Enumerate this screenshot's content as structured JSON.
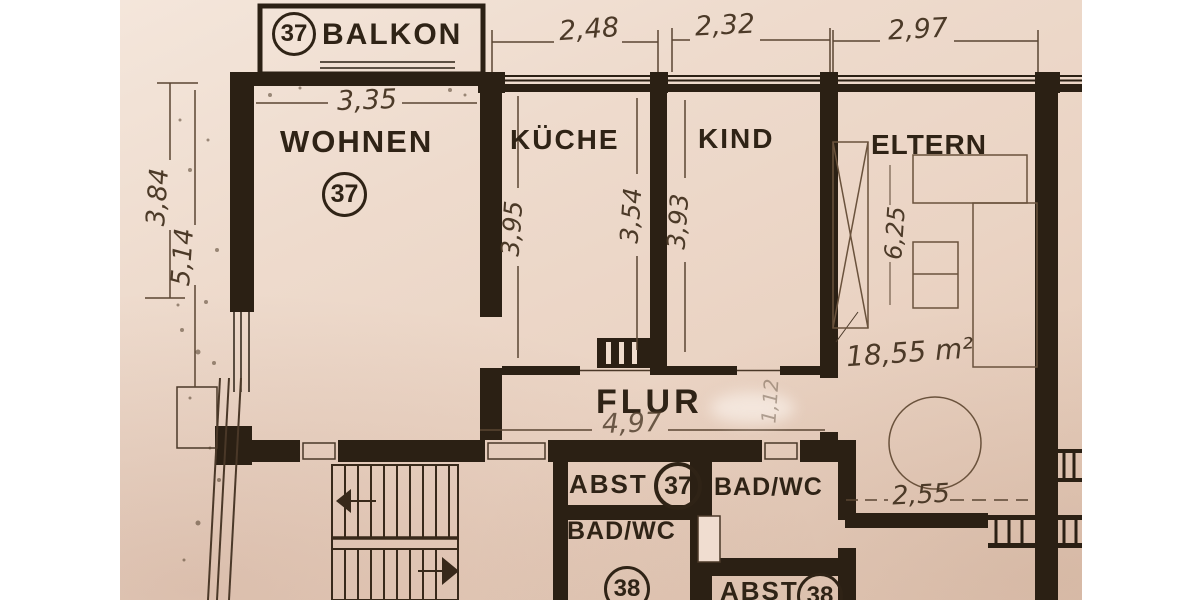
{
  "plan": {
    "balkon": {
      "unit": "37",
      "label": "BALKON"
    },
    "rooms": {
      "wohnen": {
        "label": "WOHNEN",
        "unit": "37"
      },
      "kueche": {
        "label": "KÜCHE"
      },
      "kind": {
        "label": "KIND"
      },
      "eltern": {
        "label": "ELTERN",
        "area": "18,55 m²"
      },
      "flur": {
        "label": "FLUR"
      },
      "abst37": {
        "label": "ABST",
        "unit": "37"
      },
      "badwc37": {
        "label": "BAD/WC"
      },
      "badwc38": {
        "label": "BAD/WC",
        "unit": "38"
      },
      "abst38": {
        "label": "ABST",
        "unit": "38"
      }
    },
    "dims": {
      "top_kueche": "2,48",
      "top_kind": "2,32",
      "top_eltern": "2,97",
      "wohnen_width": "3,35",
      "left_upper": "3,84",
      "left_full": "5,14",
      "kueche_depth": "3,95",
      "kueche_right_depth": "3,54",
      "kind_depth": "3,93",
      "flur_length": "4,97",
      "flur_door": "1,12",
      "eltern_depth": "6,25",
      "eltern_width": "2,55"
    },
    "colors": {
      "ink": "#2b2014",
      "paper": "#eedbcd",
      "pencil": "#5a4532"
    }
  }
}
